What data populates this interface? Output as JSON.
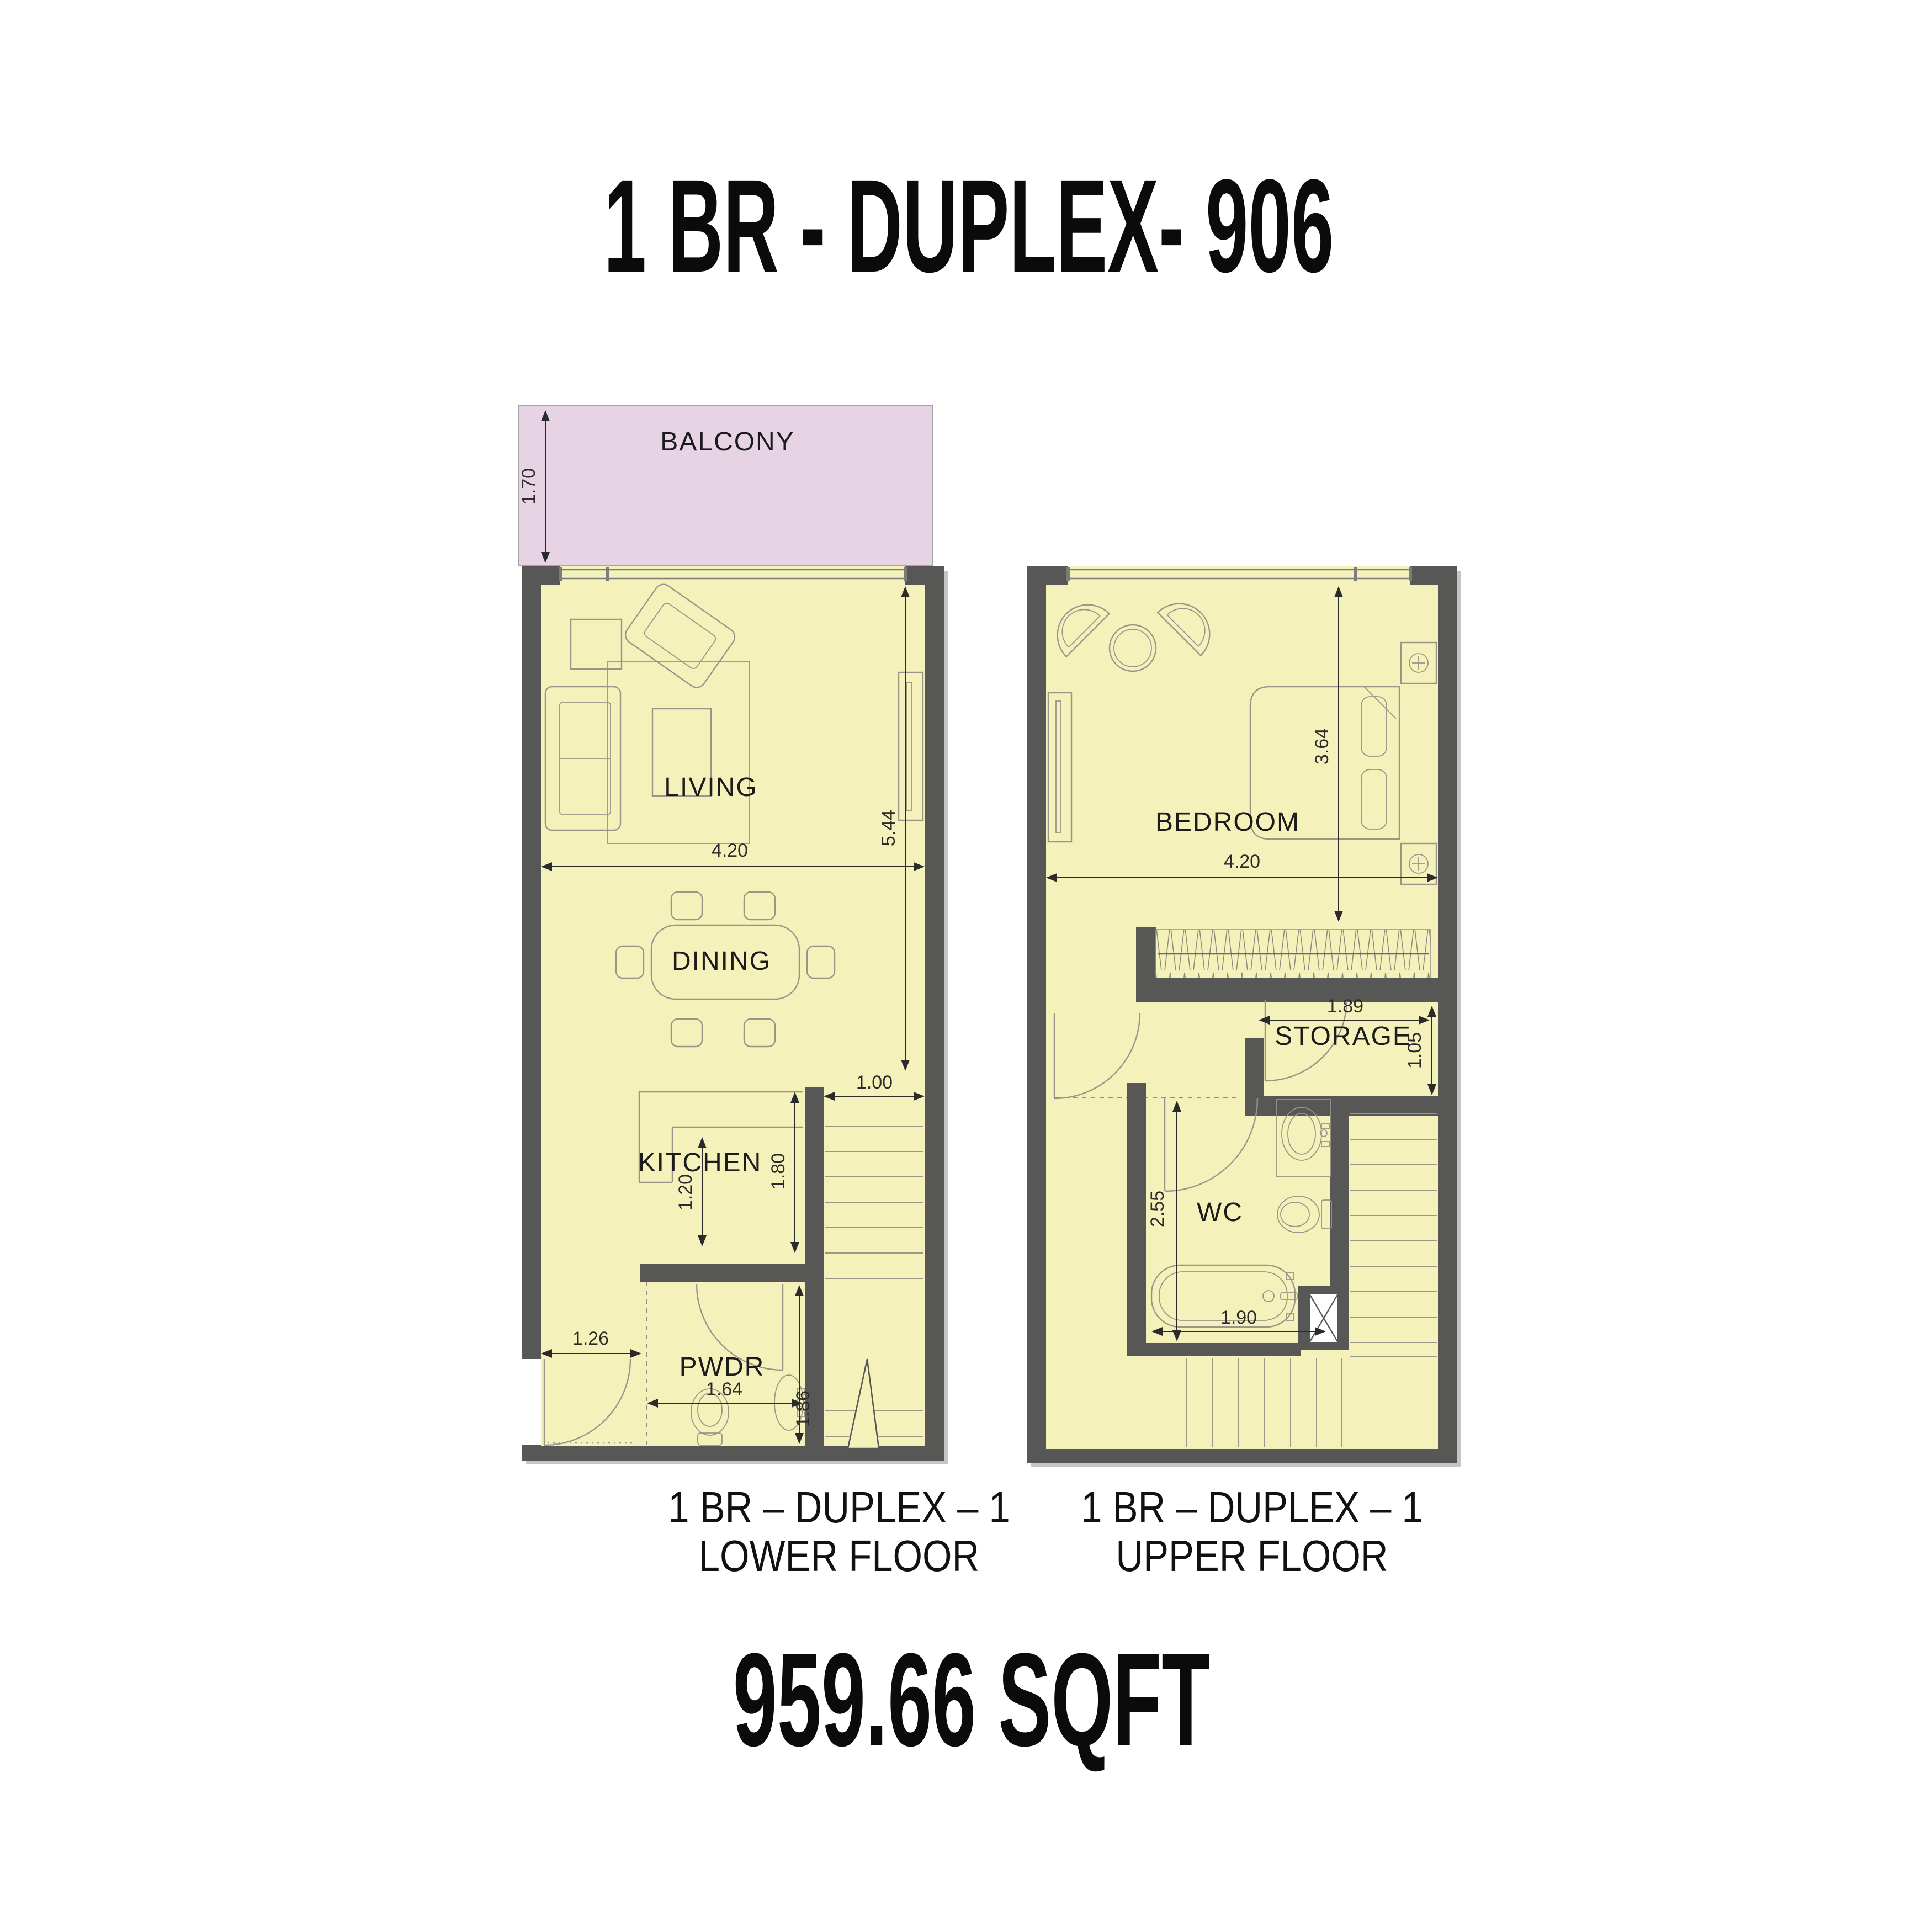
{
  "title": "1 BR - DUPLEX- 906",
  "area_label": "959.66 SQFT",
  "colors": {
    "room_fill": "#f5f1ba",
    "balcony_fill": "#e6d4e4",
    "wall": "#575756",
    "furn": "#9a9588",
    "tread": "#9c9889",
    "window": "#7c7c7c",
    "dim": "#2b2b2b",
    "text": "#1c1c1c",
    "shadow": "#c6c6c6"
  },
  "lower": {
    "caption1": "1 BR – DUPLEX – 1",
    "caption2": "LOWER FLOOR",
    "rooms": {
      "balcony": "BALCONY",
      "living": "LIVING",
      "dining": "DINING",
      "kitchen": "KITCHEN",
      "powder": "PWDR"
    },
    "dims": {
      "balcony_depth": "1.70",
      "width": "4.20",
      "living_height": "5.44",
      "stair_width": "1.00",
      "kitchen_depth": "1.80",
      "counter_width": "1.20",
      "entry_width": "1.26",
      "powder_width": "1.64",
      "powder_depth": "1.86"
    }
  },
  "upper": {
    "caption1": "1 BR – DUPLEX – 1",
    "caption2": "UPPER FLOOR",
    "rooms": {
      "bedroom": "BEDROOM",
      "storage": "STORAGE",
      "wc": "WC"
    },
    "dims": {
      "bedroom_height": "3.64",
      "width": "4.20",
      "storage_width": "1.89",
      "storage_depth": "1.05",
      "wc_height": "2.55",
      "wc_width": "1.90"
    }
  }
}
